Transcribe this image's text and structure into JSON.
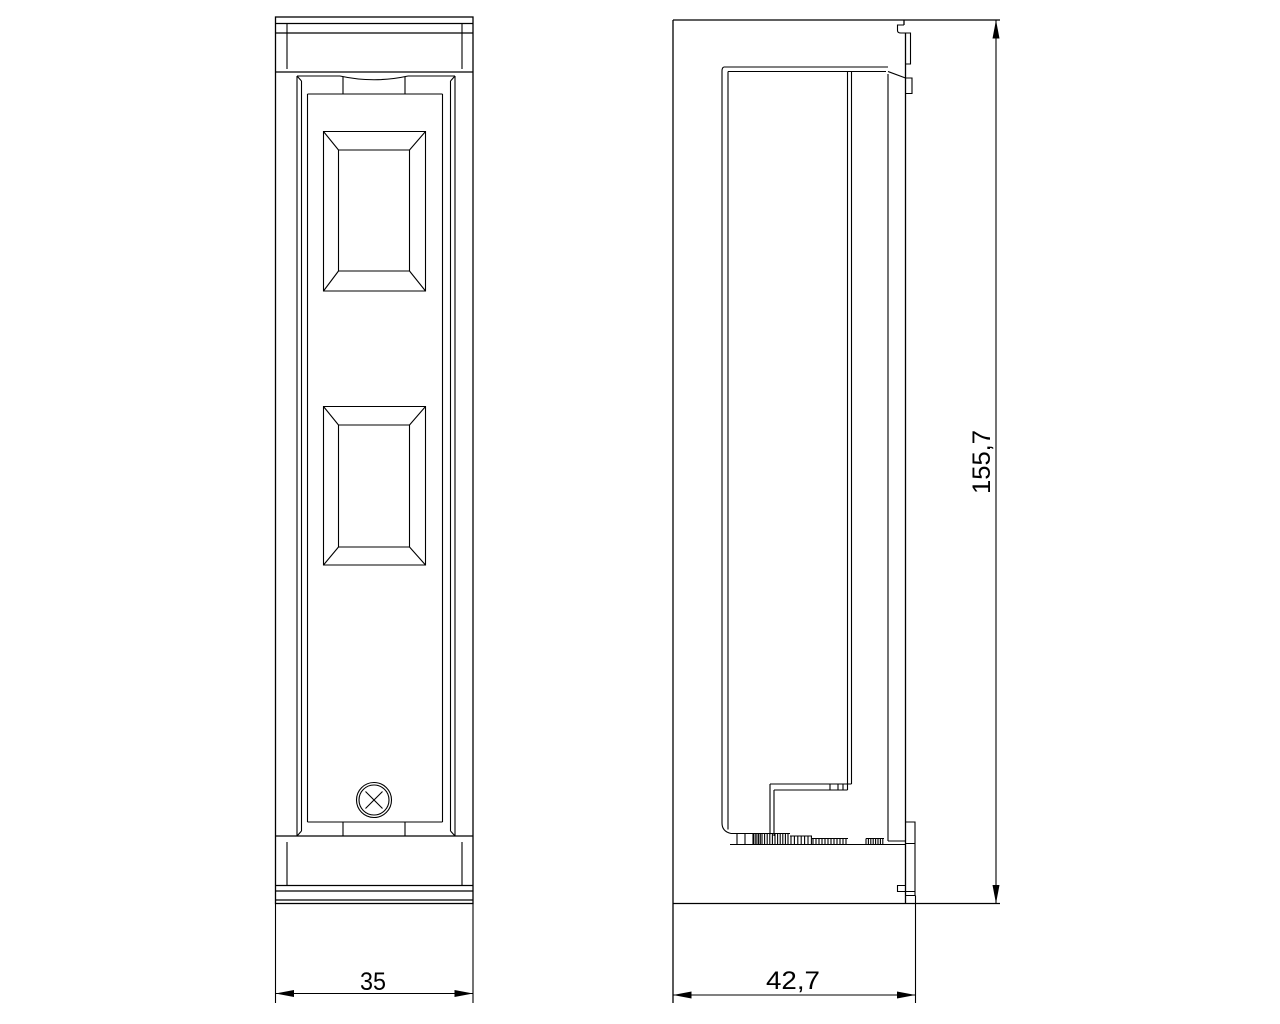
{
  "page": {
    "background_color": "#ffffff",
    "line_color": "#000000"
  },
  "drawing": {
    "type": "technical-drawing-two-views",
    "dimensions": {
      "front_width": {
        "label": "35"
      },
      "side_width": {
        "label": "42,7"
      },
      "side_height": {
        "label": "155,7"
      }
    }
  }
}
